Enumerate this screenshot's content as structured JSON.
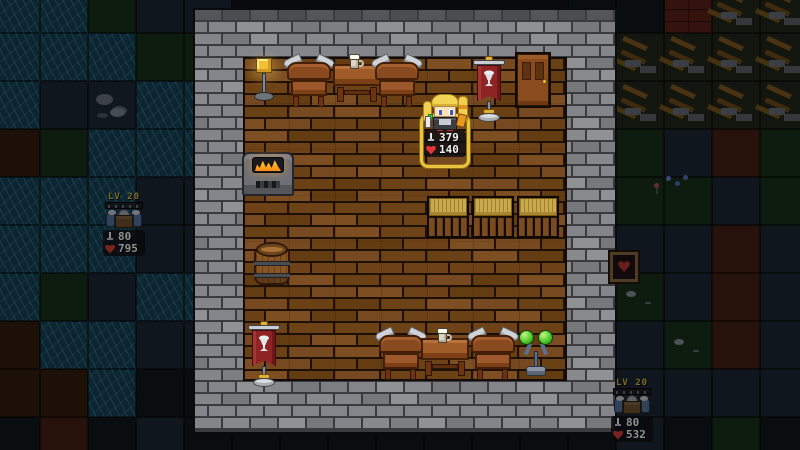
{
  "scene": {
    "name": "pixel-tavern-room",
    "description": "top-down pixel game view of a stone-walled tavern with wooden floor, surrounded by dark fog-of-war terrain"
  },
  "colors": {
    "selection": "#e9c53f",
    "heart": "#e23535",
    "stat_text": "#f2f2f2",
    "level_text": "#dcb02e",
    "wall_brick": "#85868a",
    "floor_brick": "#6d4217",
    "water": "#0c2530"
  },
  "room": {
    "x": 195,
    "y": 10,
    "w": 420,
    "h": 422,
    "floor": {
      "x": 48,
      "y": 47,
      "w": 324,
      "h": 324
    }
  },
  "tilemap": {
    "tileSize": 48,
    "offsetX": -8,
    "offsetY": -15,
    "legend": {
      "W": "tile-water",
      "G": "tile-grass-dark",
      "N": "tile-stone-dark",
      "D": "tile-dirt",
      "T": "tile-clay",
      "K": "tile-dark",
      "R": "tile-rocks",
      "B": "tile-red-bricks",
      "L": "tile-lumber-pile",
      "P": "tile-grass-pebbles"
    },
    "rows": [
      "WWGNN.......KKBLL",
      "WWWGG.......LLLLL",
      "WNRWW.......LLLLL",
      "DGWWW.......GGNTG",
      "WWWNN.......GGGNG",
      "WWWNN.......NNNTN",
      "WGNWW.......PPNTN",
      "DWWNN.......NNPTN",
      "DDWKK.......NNNNN",
      "KTKNKKKKKKKKKNKGK"
    ]
  },
  "furniture": [
    {
      "id": "lamp",
      "name": "standing-lamp",
      "x": 250,
      "y": 56
    },
    {
      "id": "chair",
      "name": "horned-chair",
      "x": 283,
      "y": 55
    },
    {
      "id": "table",
      "name": "table-with-mug",
      "x": 333,
      "y": 58,
      "mug": true
    },
    {
      "id": "chair",
      "name": "horned-chair",
      "x": 371,
      "y": 55
    },
    {
      "id": "banner",
      "name": "red-banner-stand",
      "x": 473,
      "y": 57
    },
    {
      "id": "door",
      "name": "wooden-door",
      "x": 515,
      "y": 52
    },
    {
      "id": "furnace",
      "name": "stone-furnace",
      "x": 242,
      "y": 148
    },
    {
      "id": "barrel",
      "name": "wooden-barrel",
      "x": 254,
      "y": 241
    },
    {
      "id": "banner",
      "name": "red-banner-stand",
      "x": 248,
      "y": 322
    },
    {
      "id": "hay",
      "name": "hay-bed",
      "x": 427,
      "y": 196
    },
    {
      "id": "hay",
      "name": "hay-bed",
      "x": 472,
      "y": 196
    },
    {
      "id": "hay",
      "name": "hay-bed",
      "x": 517,
      "y": 196
    },
    {
      "id": "chair",
      "name": "horned-chair",
      "x": 375,
      "y": 328
    },
    {
      "id": "table",
      "name": "table-with-mug",
      "x": 421,
      "y": 332,
      "mug": true
    },
    {
      "id": "chair",
      "name": "horned-chair",
      "x": 467,
      "y": 328
    },
    {
      "id": "orbstand",
      "name": "green-orb-stand",
      "x": 519,
      "y": 328
    },
    {
      "id": "heartsign",
      "name": "heart-sign",
      "x": 608,
      "y": 250,
      "fog": true
    },
    {
      "id": "flowers",
      "name": "wild-flowers",
      "x": 652,
      "y": 174,
      "fog": true
    }
  ],
  "units": {
    "player": {
      "x": 420,
      "y": 94,
      "attack": "379",
      "health": "140",
      "selected": true
    },
    "enemies": [
      {
        "x": 100,
        "y": 192,
        "level": "LV 20",
        "attack": "80",
        "health": "795"
      },
      {
        "x": 608,
        "y": 378,
        "level": "LV 20",
        "attack": "80",
        "health": "532"
      }
    ]
  }
}
